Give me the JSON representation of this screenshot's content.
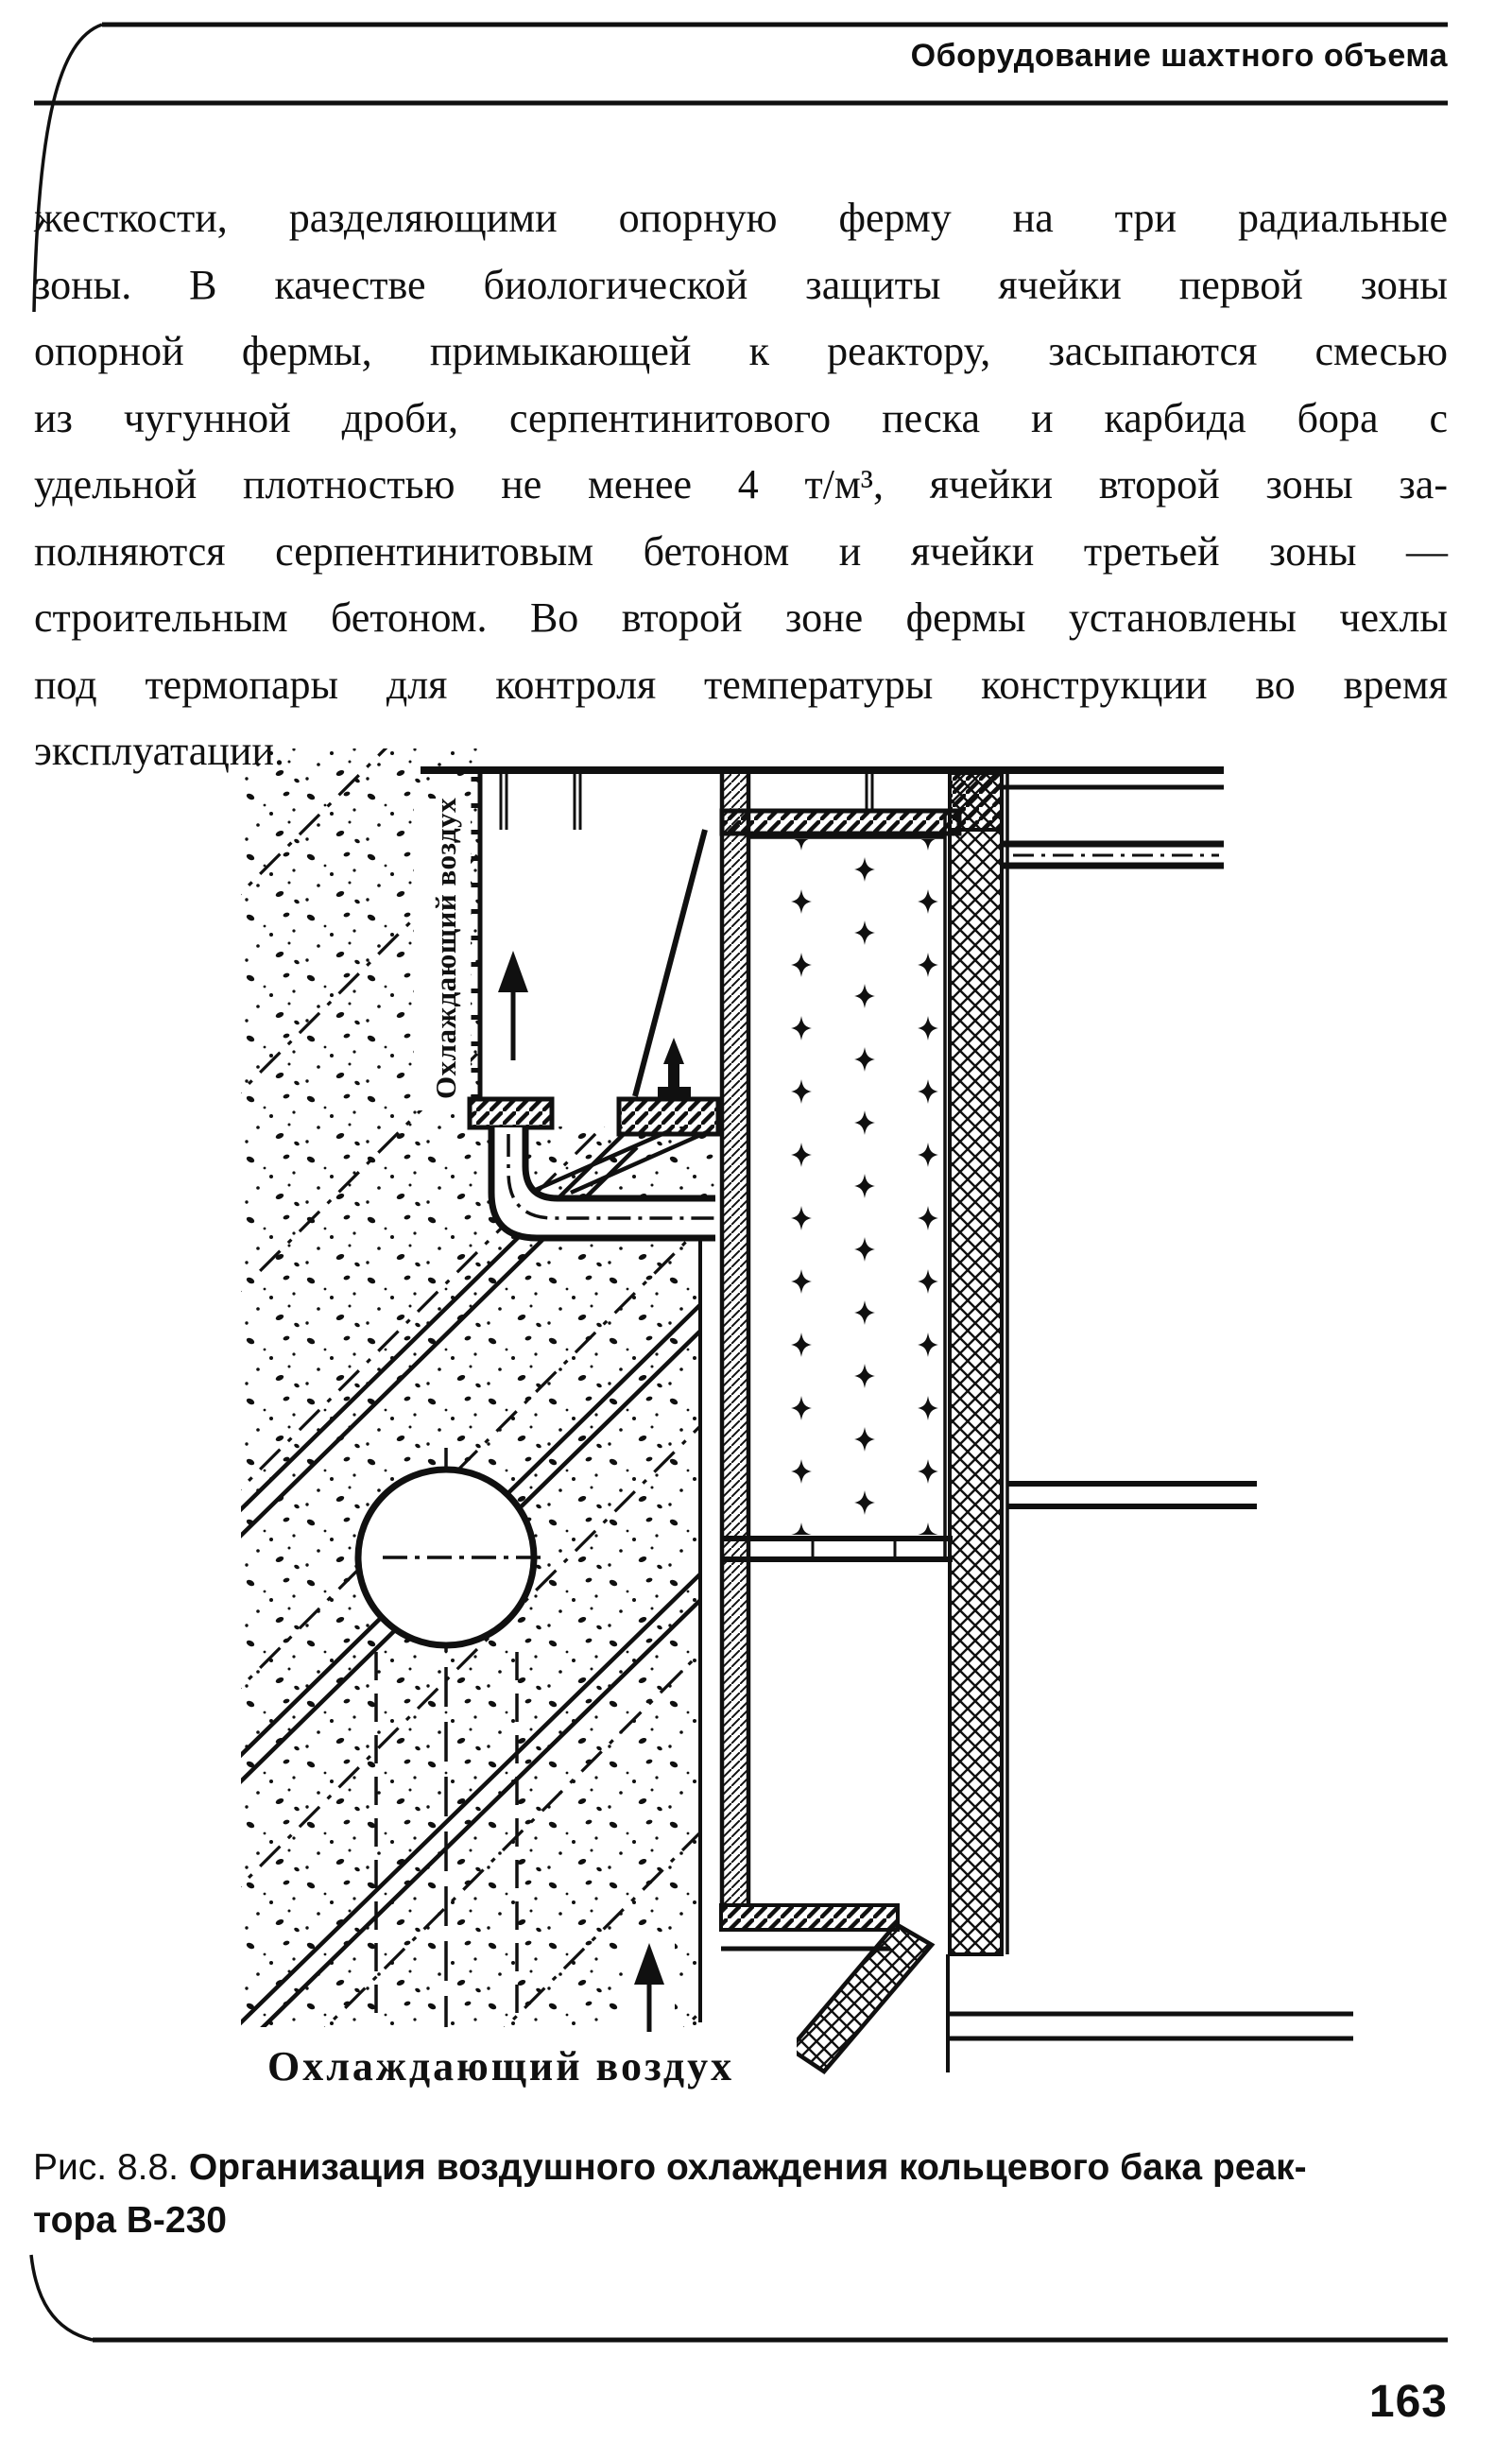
{
  "page": {
    "header": "Оборудование шахтного объема",
    "page_number": "163"
  },
  "main_text": {
    "lines": [
      "жесткости, разделяющими опорную ферму на три радиальные",
      "зоны. В качестве биологической защиты ячейки первой зоны",
      "опорной фермы, примыкающей к реактору, засыпаются смесью",
      "из чугунной дроби, серпентинитового песка и карбида бора с",
      "удельной плотностью не менее 4 т/м³, ячейки второй зоны за-",
      "полняются серпентинитовым бетоном и ячейки третьей зоны —",
      "строительным бетоном. Во второй зоне фермы установлены чехлы",
      "под термопары для контроля температуры конструкции во время",
      "эксплуатации."
    ]
  },
  "figure": {
    "label_vertical": "Охлаждающий воздух",
    "label_bottom": "Охлаждающий воздух",
    "caption_prefix": "Рис. 8.8.",
    "caption_bold": "Организация воздушного охлаждения кольцевого бака реак-",
    "caption_line2": "тора В-230"
  },
  "colors": {
    "ink": "#101010",
    "paper": "#ffffff"
  }
}
